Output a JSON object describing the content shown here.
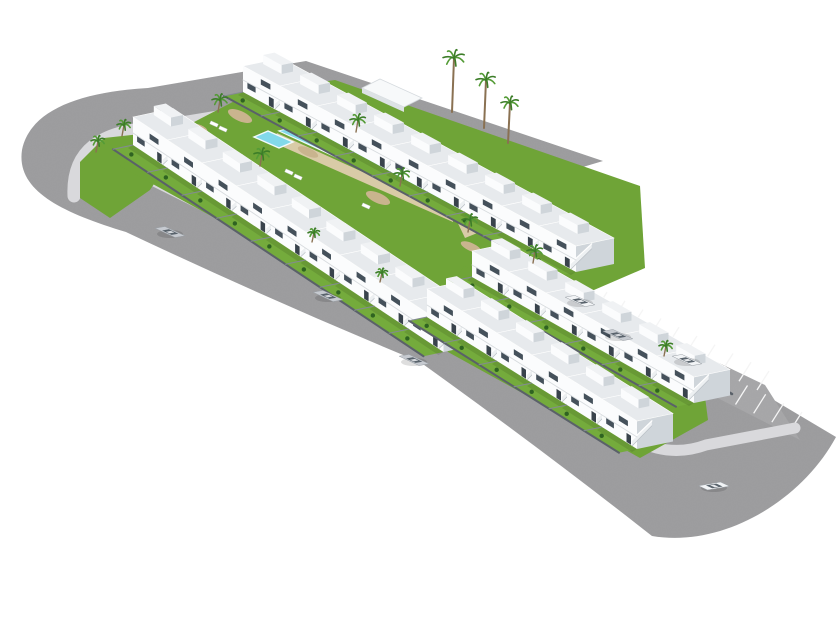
{
  "scene": {
    "description": "Aerial 3D architectural render of a white townhouse residential development with a central lawn garden and turquoise swimming pool, wrapped by gray asphalt roads with rounded corners, a diagonal parking strip with white stall lines, and several parked and driving cars on a plain white background",
    "canvas": {
      "width": 840,
      "height": 630,
      "background": "#ffffff"
    },
    "colors": {
      "asphalt": "#9e9ea0",
      "parking": "#a8a8aa",
      "stall_line": "#f5f5f5",
      "sidewalk": "#d9d9dc",
      "lawn": "#6fa437",
      "garden_lawn": "#74ab3c",
      "house_front": "#fbfcfd",
      "house_side": "#cfd5da",
      "house_roof": "#e7eaed",
      "pent_roof": "#f0f2f4",
      "stair": "#edf0f2",
      "window": "#45515b",
      "door": "#39434c",
      "fence_dark": "#5a6169",
      "fence_mid": "#838a92",
      "rail": "#ffffff",
      "pool_main": "#36bcdd",
      "pool_shallow": "#82d9ea",
      "pool_deep": "#0f8fc2",
      "pool_rim": "#f2fafc",
      "deck": "#d9cba7",
      "gravel": "#c9b48e",
      "palm_trunk": "#8a7152",
      "palm_frond": "#3c7d28",
      "palm_frond_light": "#549b36",
      "bush": "#2f6321",
      "car_silver": "#c6cad0",
      "car_white": "#f2f4f6",
      "car_glass": "#59636c",
      "shadow": "rgba(0,0,0,0.13)"
    },
    "roads": {
      "ring_d": "M 603 161 L 306 61 L 148 88 C 80 92 30 110 22 150 C 16 190 60 212 126 232 Q 270 300 420 362 Q 540 448 652 536 C 724 548 802 500 836 437 L 757 390 L 430 240 L 160 121 L 306 97 L 556 175 Z",
      "sidewalks": [
        {
          "d": "M 162 127 C 98 130 72 152 74 196",
          "w": 13
        },
        {
          "d": "M 116 162 L 448 327",
          "w": 11
        },
        {
          "d": "M 448 327 L 455 347 L 630 437 Q 668 459 706 445 L 795 428",
          "w": 11
        },
        {
          "d": "M 160 124 L 306 100",
          "w": 8
        },
        {
          "d": "M 306 100 L 553 180",
          "w": 8
        }
      ],
      "corner_green_strip": [
        [
          158,
          132
        ],
        [
          104,
          138
        ],
        [
          80,
          162
        ],
        [
          80,
          198
        ],
        [
          110,
          218
        ],
        [
          150,
          190
        ],
        [
          170,
          160
        ]
      ]
    },
    "parking": {
      "outline": [
        [
          441,
          230
        ],
        [
          765,
          385
        ],
        [
          800,
          440
        ],
        [
          470,
          272
        ]
      ],
      "rows": [
        {
          "from": [
            451,
            241
          ],
          "to": [
            757,
            390
          ],
          "count": 18,
          "vec": [
            12,
            -19
          ]
        },
        {
          "from": [
            463,
            272
          ],
          "to": [
            790,
            431
          ],
          "count": 19,
          "vec": [
            12,
            -19
          ]
        }
      ]
    },
    "blocks": [
      {
        "name": "residential-block-1",
        "lawn": [
          [
            140,
            150
          ],
          [
            252,
            92
          ],
          [
            335,
            80
          ],
          [
            640,
            186
          ],
          [
            645,
            268
          ],
          [
            455,
            350
          ],
          [
            120,
            166
          ]
        ],
        "back_fence": null,
        "rows": [
          {
            "name": "back-row",
            "anchor": [
              243,
              92
            ],
            "b": [
              37,
              20
            ],
            "a": [
              38,
              -8
            ],
            "h": 26,
            "count": 9
          },
          {
            "name": "front-row",
            "anchor": [
              133,
              145
            ],
            "b": [
              34.5,
              23
            ],
            "a": [
              40,
              -8.5
            ],
            "h": 28,
            "count": 9
          }
        ]
      },
      {
        "name": "residential-block-2",
        "lawn": [
          [
            430,
            320
          ],
          [
            464,
            266
          ],
          [
            702,
            374
          ],
          [
            708,
            420
          ],
          [
            640,
            458
          ],
          [
            448,
            352
          ]
        ],
        "back_fence": {
          "x1": 506,
          "y1": 268,
          "x2": 732,
          "y2": 394
        },
        "rows": [
          {
            "name": "back-row",
            "anchor": [
              472,
              277
            ],
            "b": [
              37,
              21
            ],
            "a": [
              36,
              -7.5
            ],
            "h": 26,
            "count": 6
          },
          {
            "name": "front-row",
            "anchor": [
              427,
              317
            ],
            "b": [
              35,
              22
            ],
            "a": [
              36,
              -7.5
            ],
            "h": 28,
            "count": 6
          }
        ]
      }
    ],
    "garden": {
      "pool": {
        "main": [
          [
            280,
            131
          ],
          [
            452,
            210
          ],
          [
            477,
            204
          ],
          [
            305,
            125
          ]
        ],
        "shallow": [
          [
            280,
            131
          ],
          [
            318,
            148
          ],
          [
            340,
            143
          ],
          [
            302,
            126
          ]
        ],
        "deep": [
          [
            370,
            172
          ],
          [
            452,
            210
          ],
          [
            477,
            204
          ],
          [
            395,
            166
          ]
        ],
        "kiddie": [
          [
            254,
            137
          ],
          [
            279,
            148
          ],
          [
            293,
            142
          ],
          [
            268,
            131
          ]
        ],
        "deck": [
          [
            [
              277,
              133
            ],
            [
              453,
              213
            ],
            [
              453,
              222
            ],
            [
              272,
              142
            ]
          ],
          [
            [
              453,
              213
            ],
            [
              479,
              207
            ],
            [
              497,
              225
            ],
            [
              465,
              238
            ]
          ]
        ]
      },
      "shed": {
        "top": [
          [
            362,
            88
          ],
          [
            404,
            107
          ],
          [
            422,
            98
          ],
          [
            380,
            79
          ]
        ],
        "front": [
          [
            362,
            88
          ],
          [
            404,
            107
          ],
          [
            404,
            112
          ],
          [
            362,
            93
          ]
        ]
      },
      "gravel": [
        {
          "c": [
            240,
            116
          ],
          "rx": 13,
          "ry": 5
        },
        {
          "c": [
            308,
            152
          ],
          "rx": 11,
          "ry": 4
        },
        {
          "c": [
            378,
            198
          ],
          "rx": 13,
          "ry": 5
        },
        {
          "c": [
            333,
            247
          ],
          "rx": 9,
          "ry": 3.5
        },
        {
          "c": [
            471,
            247
          ],
          "rx": 11,
          "ry": 4
        },
        {
          "c": [
            517,
            206
          ],
          "rx": 9,
          "ry": 3.5
        },
        {
          "c": [
            200,
            128
          ],
          "rx": 8,
          "ry": 3
        }
      ],
      "loungers": [
        [
          214,
          124
        ],
        [
          223,
          129
        ],
        [
          289,
          172
        ],
        [
          298,
          177
        ],
        [
          418,
          161
        ],
        [
          427,
          166
        ],
        [
          366,
          206
        ]
      ],
      "parasol": {
        "c": [
          410,
          154
        ],
        "r": 4.5
      },
      "palms": [
        {
          "x": 218,
          "y": 112,
          "r": 8,
          "trunk": 12
        },
        {
          "x": 260,
          "y": 166,
          "r": 8,
          "trunk": 12
        },
        {
          "x": 356,
          "y": 132,
          "r": 8,
          "trunk": 12
        },
        {
          "x": 400,
          "y": 186,
          "r": 8,
          "trunk": 12
        },
        {
          "x": 468,
          "y": 232,
          "r": 8,
          "trunk": 12
        },
        {
          "x": 533,
          "y": 263,
          "r": 8,
          "trunk": 12
        },
        {
          "x": 96,
          "y": 152,
          "r": 7,
          "trunk": 11
        },
        {
          "x": 122,
          "y": 136,
          "r": 7,
          "trunk": 11
        },
        {
          "x": 312,
          "y": 242,
          "r": 6,
          "trunk": 9
        },
        {
          "x": 380,
          "y": 282,
          "r": 6,
          "trunk": 9
        },
        {
          "x": 664,
          "y": 356,
          "r": 7,
          "trunk": 10
        },
        {
          "x": 452,
          "y": 112,
          "r": 11,
          "trunk": 54
        },
        {
          "x": 484,
          "y": 128,
          "r": 10,
          "trunk": 48
        },
        {
          "x": 508,
          "y": 143,
          "r": 9,
          "trunk": 40
        }
      ]
    },
    "cars": [
      {
        "x": 170,
        "y": 232,
        "dir": "B",
        "color": "silver"
      },
      {
        "x": 328,
        "y": 296,
        "dir": "B",
        "color": "silver"
      },
      {
        "x": 414,
        "y": 360,
        "dir": "B",
        "color": "silver"
      },
      {
        "x": 580,
        "y": 301,
        "dir": "B",
        "color": "white"
      },
      {
        "x": 618,
        "y": 335,
        "dir": "B",
        "color": "silver"
      },
      {
        "x": 687,
        "y": 360,
        "dir": "B",
        "color": "white"
      },
      {
        "x": 714,
        "y": 486,
        "dir": "A",
        "color": "white"
      }
    ]
  }
}
